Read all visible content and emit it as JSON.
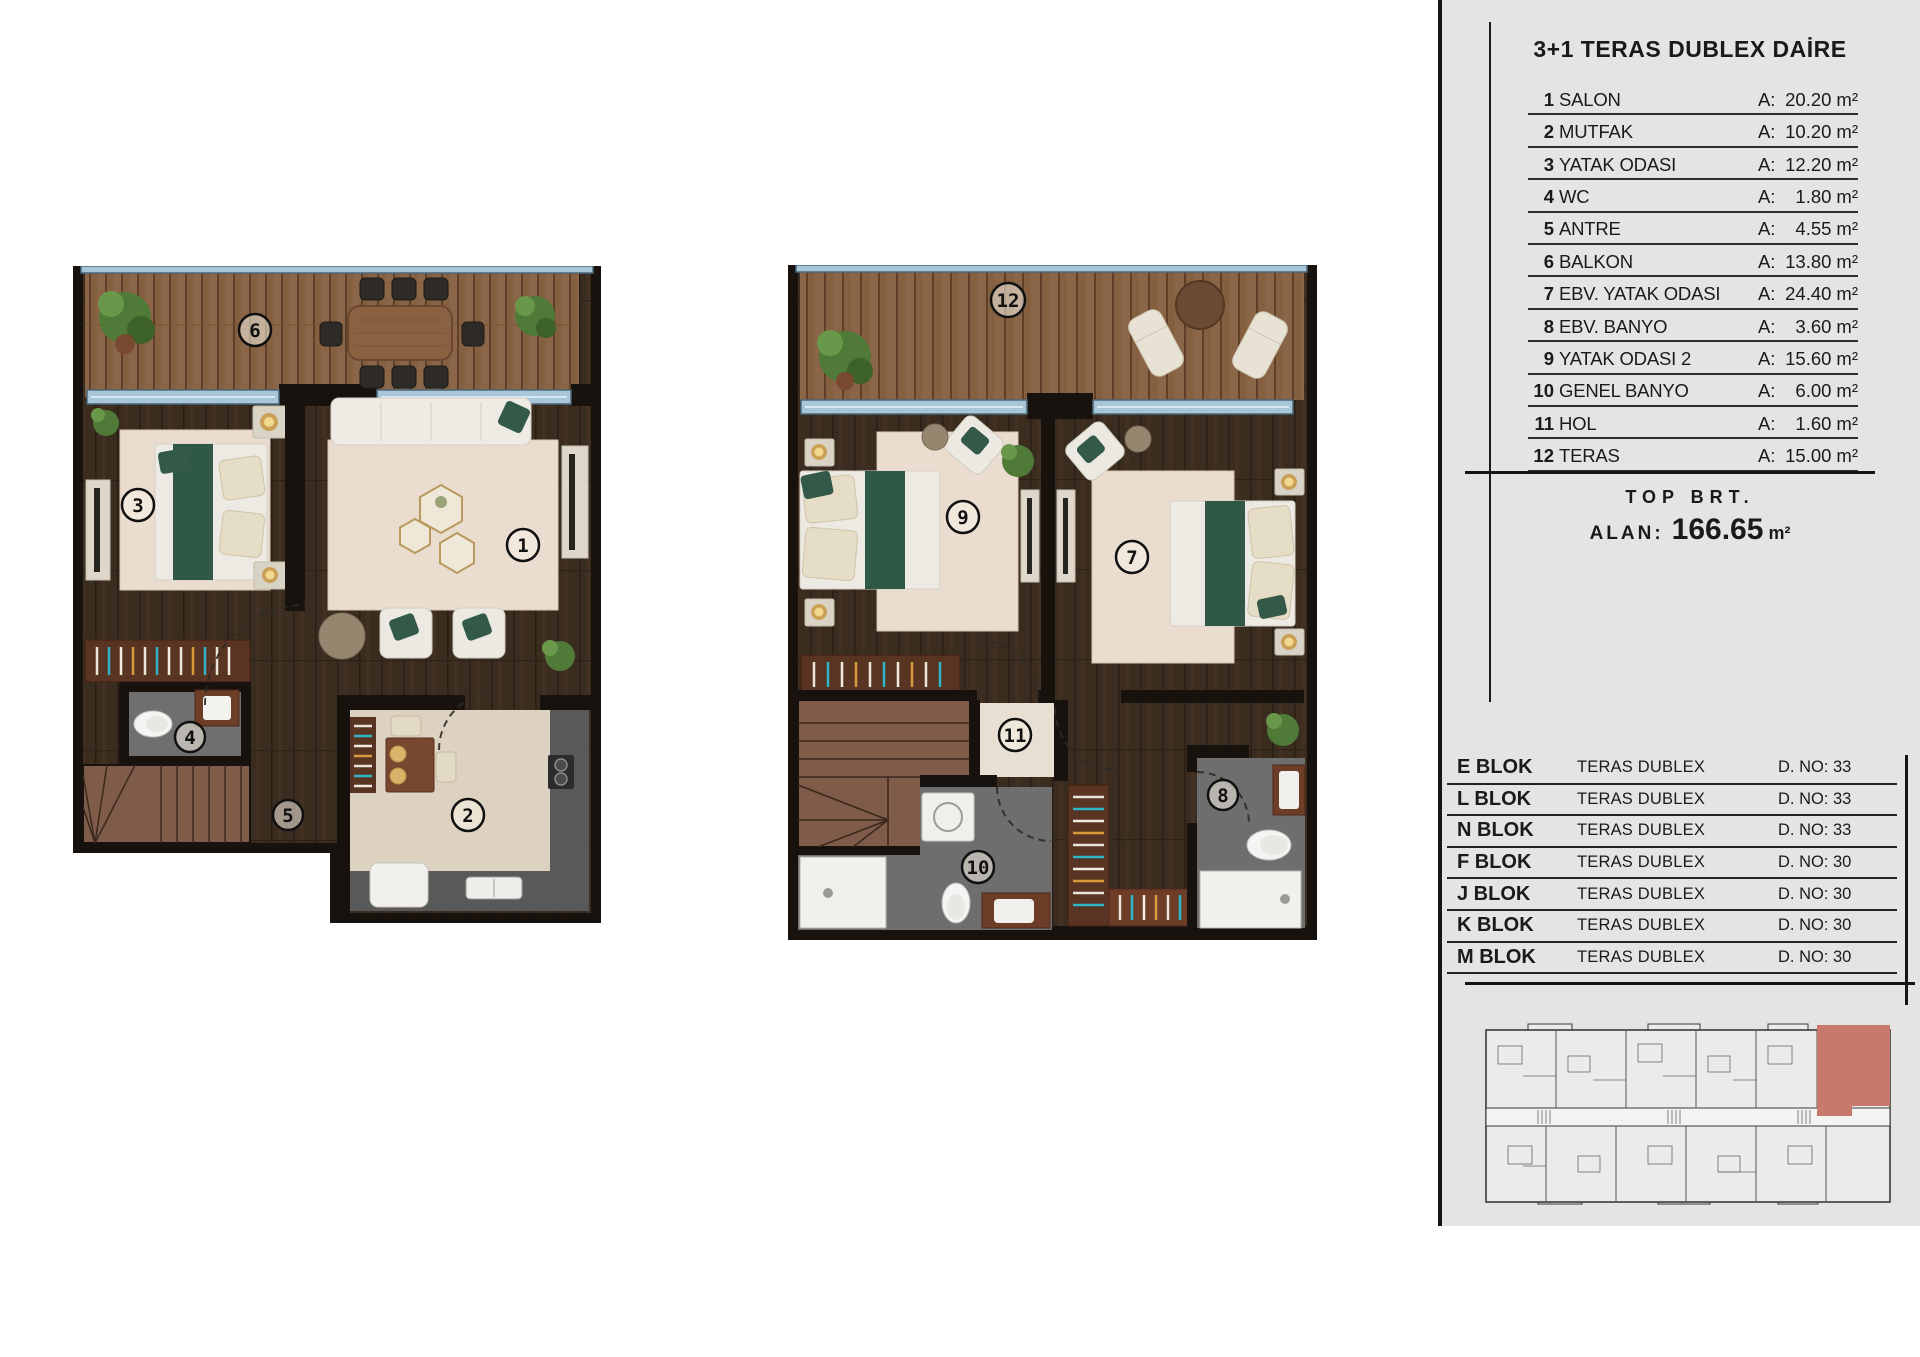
{
  "panel": {
    "title": "3+1 TERAS DUBLEX DAİRE",
    "area_prefix": "A:",
    "area_unit": "m²",
    "rooms": [
      {
        "num": "1",
        "name": "SALON",
        "area": "20.20"
      },
      {
        "num": "2",
        "name": "MUTFAK",
        "area": "10.20"
      },
      {
        "num": "3",
        "name": "YATAK ODASI",
        "area": "12.20"
      },
      {
        "num": "4",
        "name": "WC",
        "area": "1.80"
      },
      {
        "num": "5",
        "name": "ANTRE",
        "area": "4.55"
      },
      {
        "num": "6",
        "name": "BALKON",
        "area": "13.80"
      },
      {
        "num": "7",
        "name": "EBV. YATAK ODASI",
        "area": "24.40"
      },
      {
        "num": "8",
        "name": "EBV. BANYO",
        "area": "3.60"
      },
      {
        "num": "9",
        "name": "YATAK ODASI 2",
        "area": "15.60"
      },
      {
        "num": "10",
        "name": "GENEL BANYO",
        "area": "6.00"
      },
      {
        "num": "11",
        "name": "HOL",
        "area": "1.60"
      },
      {
        "num": "12",
        "name": "TERAS",
        "area": "15.00"
      }
    ],
    "total": {
      "line1": "TOP BRT.",
      "label": "ALAN:",
      "value": "166.65",
      "unit": "m²"
    },
    "blocks": [
      {
        "name": "E BLOK",
        "type": "TERAS DUBLEX",
        "dno": "D. NO: 33"
      },
      {
        "name": "L BLOK",
        "type": "TERAS DUBLEX",
        "dno": "D. NO: 33"
      },
      {
        "name": "N BLOK",
        "type": "TERAS DUBLEX",
        "dno": "D. NO: 33"
      },
      {
        "name": "F BLOK",
        "type": "TERAS DUBLEX",
        "dno": "D. NO: 30"
      },
      {
        "name": "J BLOK",
        "type": "TERAS DUBLEX",
        "dno": "D. NO: 30"
      },
      {
        "name": "K BLOK",
        "type": "TERAS DUBLEX",
        "dno": "D. NO: 30"
      },
      {
        "name": "M BLOK",
        "type": "TERAS DUBLEX",
        "dno": "D. NO: 30"
      }
    ]
  },
  "plans": {
    "lower": {
      "markers": [
        {
          "label": "6"
        },
        {
          "label": "3"
        },
        {
          "label": "1"
        },
        {
          "label": "4"
        },
        {
          "label": "5"
        },
        {
          "label": "2"
        }
      ]
    },
    "upper": {
      "markers": [
        {
          "label": "12"
        },
        {
          "label": "9"
        },
        {
          "label": "7"
        },
        {
          "label": "11"
        },
        {
          "label": "10"
        },
        {
          "label": "8"
        }
      ]
    }
  },
  "colors": {
    "panel_bg": "#e4e4e2",
    "line": "#1a1a1a",
    "highlight_unit": "#c8796c",
    "deck_wood": "#8a6547",
    "floor_wood": "#3b2c20",
    "glass": "#a9c6d9",
    "rug": "#eadcce",
    "green_accent": "#2f5847",
    "bath_floor": "#707070",
    "light_floor": "#ddd2c1"
  }
}
